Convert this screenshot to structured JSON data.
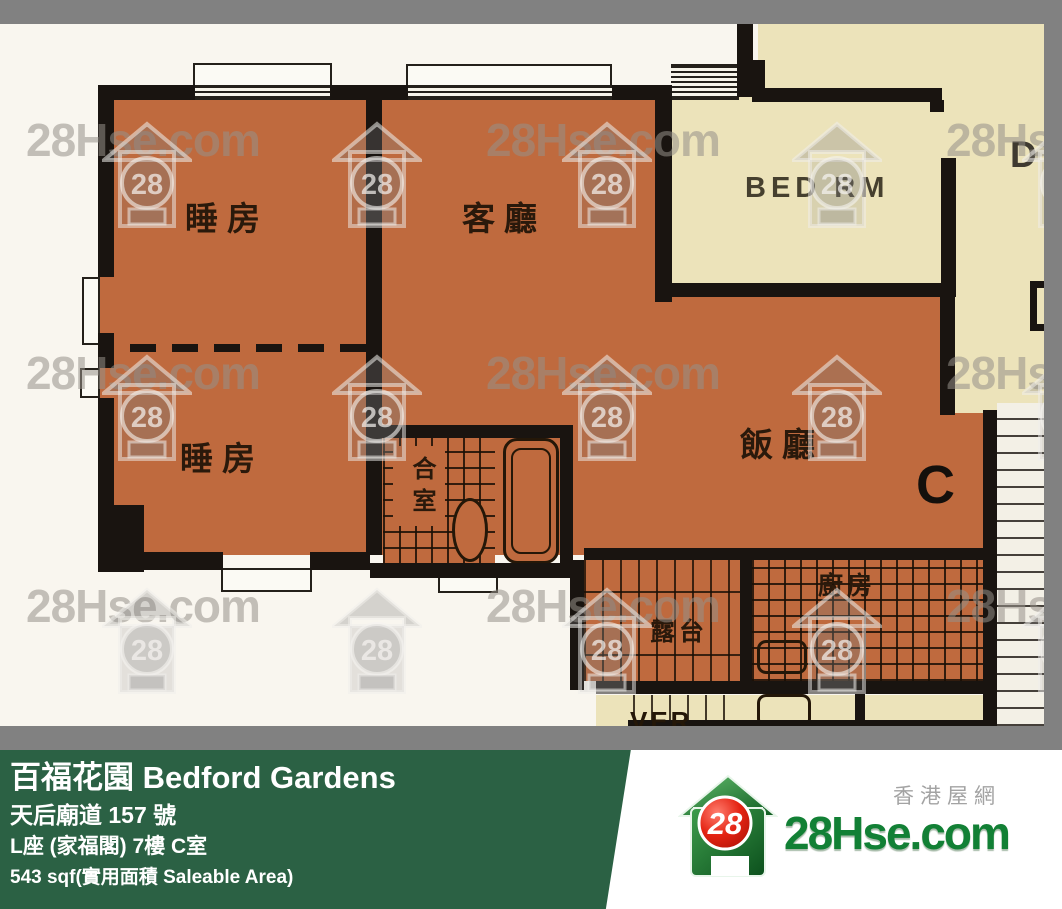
{
  "watermark": {
    "text": "28Hse.com",
    "badge": "28"
  },
  "plan": {
    "labels": {
      "bedroom_top": "睡房",
      "living": "客廳",
      "bed_rm": "BED RM",
      "bedroom_bottom": "睡房",
      "dining": "飯廳",
      "bathroom": "合室",
      "balcony": "露台",
      "kitchen": "廚房",
      "verandah": "VER",
      "unit_c": "C",
      "unit_d": "D"
    },
    "colors": {
      "room_orange": "#bf6a3e",
      "adjacent_cream": "#ece3ba",
      "wall_black": "#191410",
      "paper_white": "#f9f6ef",
      "frame_gray": "#818181"
    }
  },
  "banner": {
    "title": "百福花園 Bedford Gardens",
    "address": "天后廟道 157 號",
    "unit": "L座 (家福閣) 7樓 C室",
    "area": "543 sqf(實用面積 Saleable Area)",
    "bg_green": "#2b6144"
  },
  "logo": {
    "badge": "28",
    "site": "28Hse.com",
    "tagline": "香港屋網"
  }
}
